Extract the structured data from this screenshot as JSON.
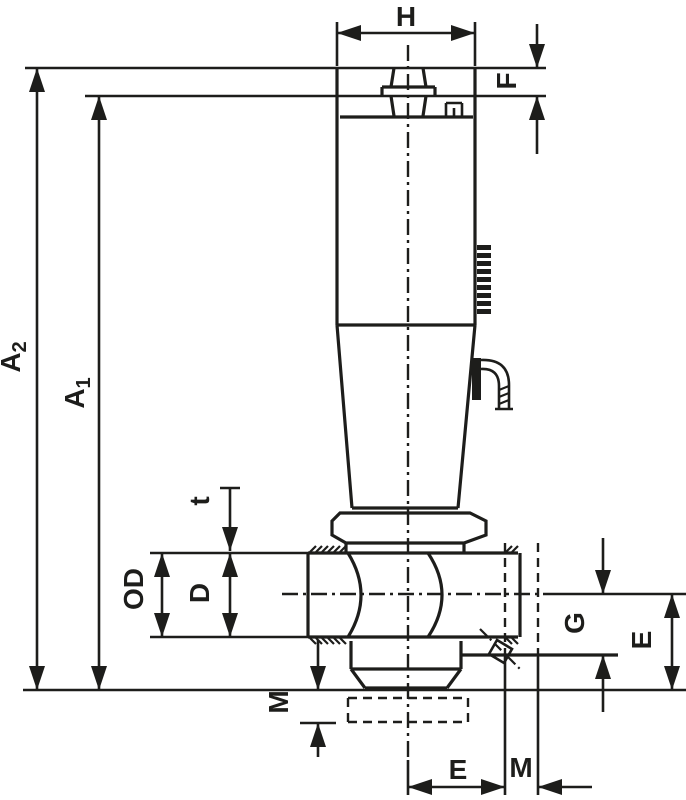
{
  "page": {
    "background": "#ffffff",
    "line_color": "#1d1d1b"
  },
  "drawing": {
    "description": "Dimensional outline drawing of a valve with tall handle, threaded left port, right port and bottom threaded connection",
    "dimension_labels": {
      "h": "H",
      "f": "F",
      "a2": {
        "base": "A",
        "sub": "2"
      },
      "a1": {
        "base": "A",
        "sub": "1"
      },
      "t": "t",
      "od": "OD",
      "d": "D",
      "m_left": "M",
      "g": "G",
      "e_right": "E",
      "e_bottom": "E",
      "m_bottom": "M"
    }
  }
}
